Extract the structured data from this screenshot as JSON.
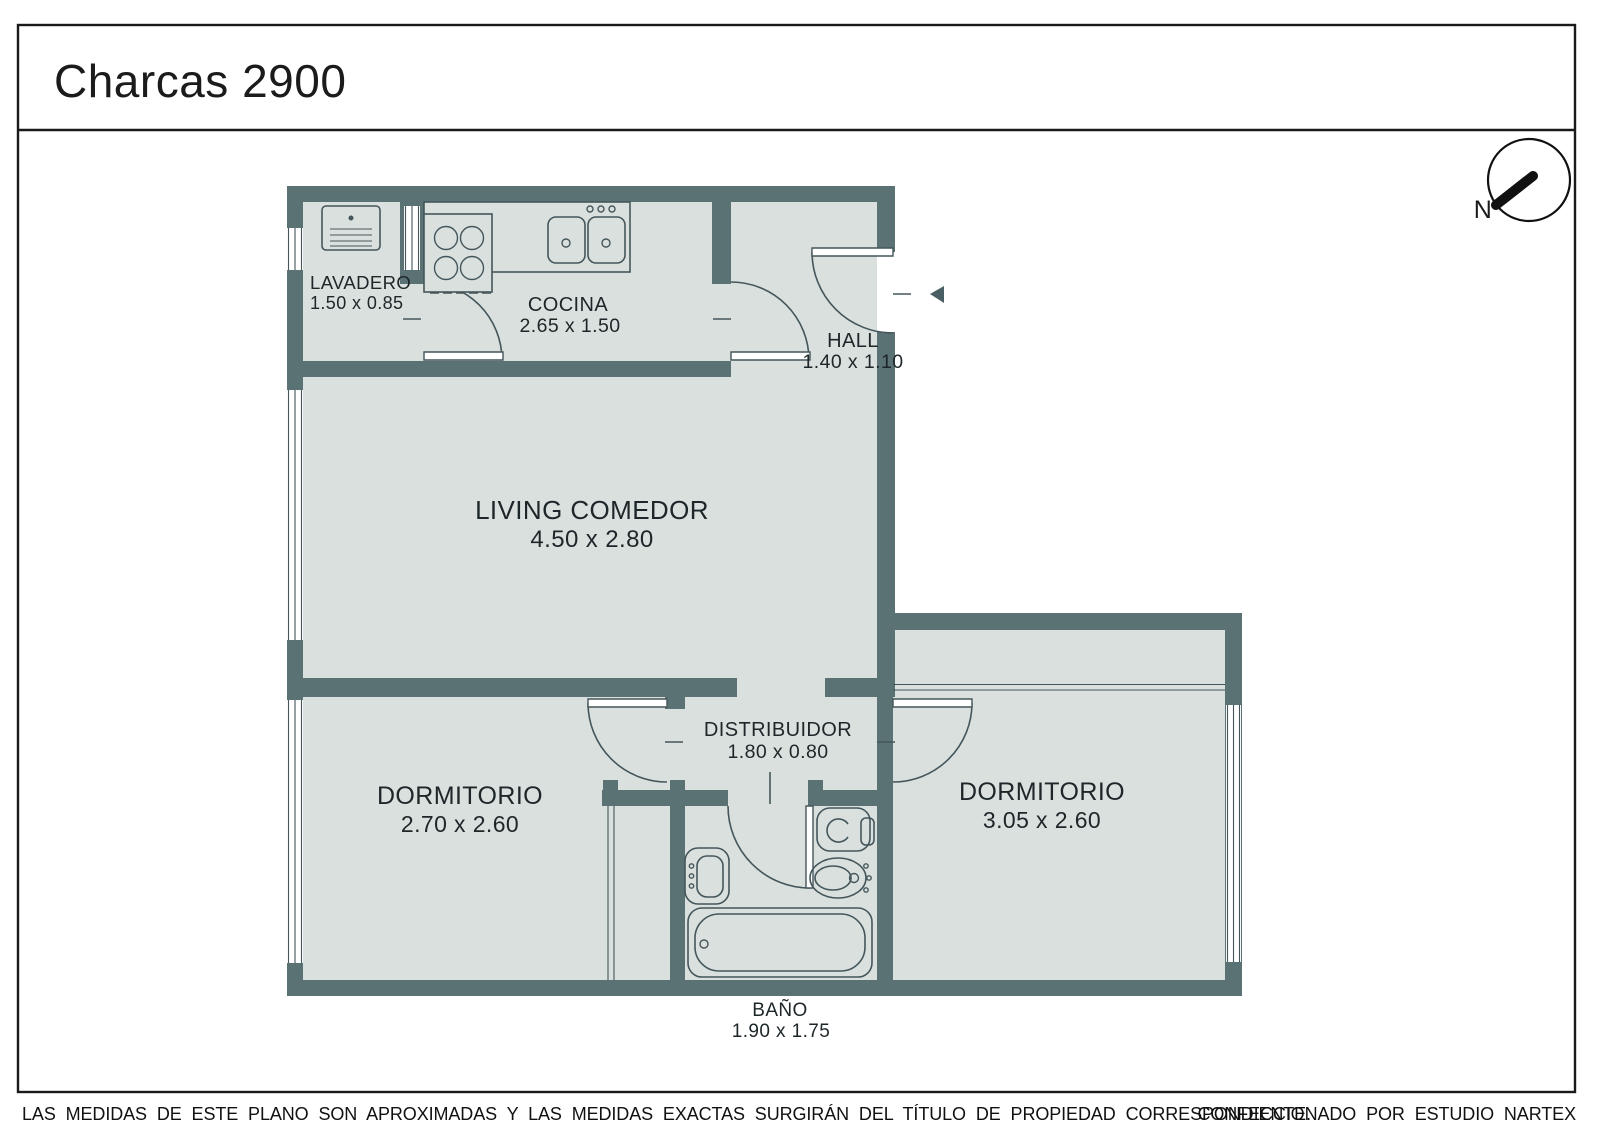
{
  "title": "Charcas 2900",
  "compass": {
    "north_label": "N"
  },
  "plan": {
    "rooms": {
      "lavadero": {
        "name": "LAVADERO",
        "dims": "1.50 x 0.85"
      },
      "cocina": {
        "name": "COCINA",
        "dims": "2.65 x 1.50"
      },
      "hall": {
        "name": "HALL",
        "dims": "1.40 x 1.10"
      },
      "living": {
        "name": "LIVING COMEDOR",
        "dims": "4.50 x 2.80"
      },
      "dormitorio_izq": {
        "name": "DORMITORIO",
        "dims": "2.70 x 2.60"
      },
      "distribuidor": {
        "name": "DISTRIBUIDOR",
        "dims": "1.80 x 0.80"
      },
      "dormitorio_der": {
        "name": "DORMITORIO",
        "dims": "3.05 x 2.60"
      },
      "bano": {
        "name": "BAÑO",
        "dims": "1.90 x 1.75"
      }
    }
  },
  "footer": {
    "disclaimer": "LAS MEDIDAS  DE ESTE PLANO SON APROXIMADAS Y LAS MEDIDAS EXACTAS SURGIRÁN DEL TÍTULO DE PROPIEDAD CORRESPONDIENTE.",
    "credit": "CONFECCIONADO POR ESTUDIO NARTEX"
  },
  "colors": {
    "wall": "#5b7275",
    "floor": "#dae0de",
    "fixture_line": "#44565b",
    "text": "#1d2629",
    "page_border": "#1a1a1a",
    "compass": "#111111"
  }
}
